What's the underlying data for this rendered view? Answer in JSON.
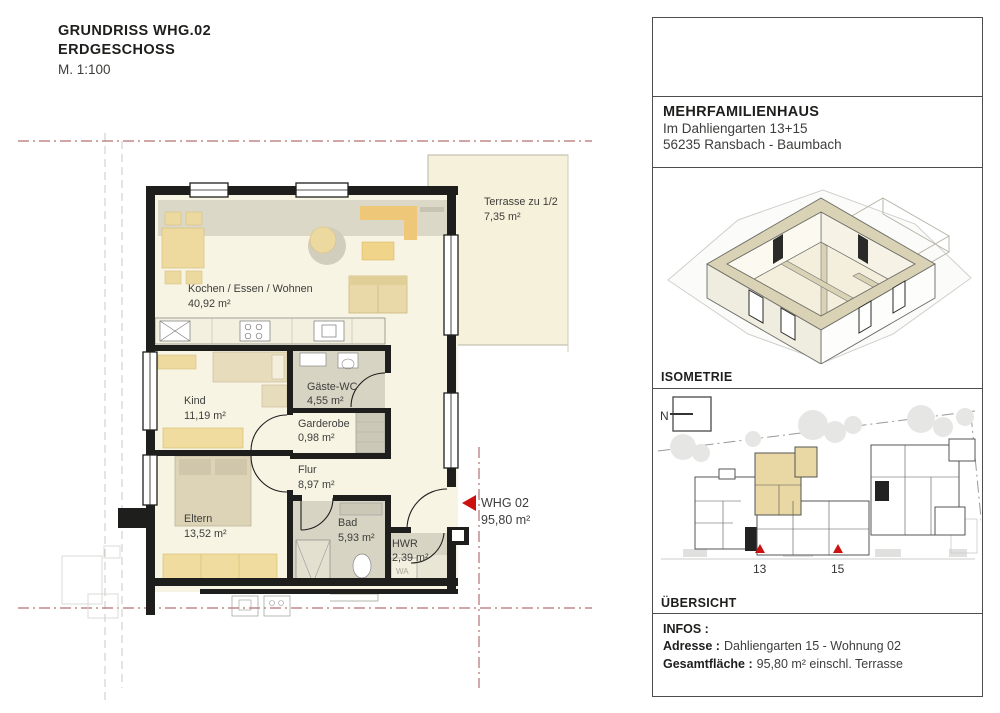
{
  "document": {
    "title_line1": "GRUNDRISS WHG.02",
    "title_line2": "ERDGESCHOSS",
    "scale": "M. 1:100"
  },
  "plan": {
    "terrace": {
      "name": "Terrasse zu 1/2",
      "area": "7,35 m²"
    },
    "rooms": {
      "wohnen": {
        "name": "Kochen / Essen / Wohnen",
        "area": "40,92 m²"
      },
      "kind": {
        "name": "Kind",
        "area": "11,19 m²"
      },
      "gaeste_wc": {
        "name": "Gäste-WC",
        "area": "4,55 m²"
      },
      "garderobe": {
        "name": "Garderobe",
        "area": "0,98 m²"
      },
      "flur": {
        "name": "Flur",
        "area": "8,97 m²"
      },
      "bad": {
        "name": "Bad",
        "area": "5,93 m²"
      },
      "hwr": {
        "name": "HWR",
        "area": "2,39 m²"
      },
      "eltern": {
        "name": "Eltern",
        "area": "13,52 m²"
      }
    },
    "unit": {
      "label": "WHG 02",
      "area": "95,80 m²"
    },
    "washer_label": "WA"
  },
  "right_panel": {
    "address": {
      "title": "MEHRFAMILIENHAUS",
      "street": "Im Dahliengarten 13+15",
      "city": "56235 Ransbach - Baumbach"
    },
    "isometrie_label": "ISOMETRIE",
    "uebersicht_label": "ÜBERSICHT",
    "site": {
      "north_label": "N",
      "house_number_left": "13",
      "house_number_right": "15"
    },
    "infos": {
      "heading": "INFOS :",
      "address_label": "Adresse :",
      "address_value": "Dahliengarten 15 - Wohnung 02",
      "area_label": "Gesamtfläche :",
      "area_value": "95,80 m² einschl. Terrasse"
    }
  },
  "colors": {
    "accent_red": "#cc1111",
    "boundary_red": "#b37070",
    "wall_black": "#1e1e1c",
    "floor_cream": "#f8f4e4",
    "tile_gray": "#d8d4c4",
    "furniture_tan": "#ecd9a0",
    "highlight_tan": "#e9d7a4"
  }
}
